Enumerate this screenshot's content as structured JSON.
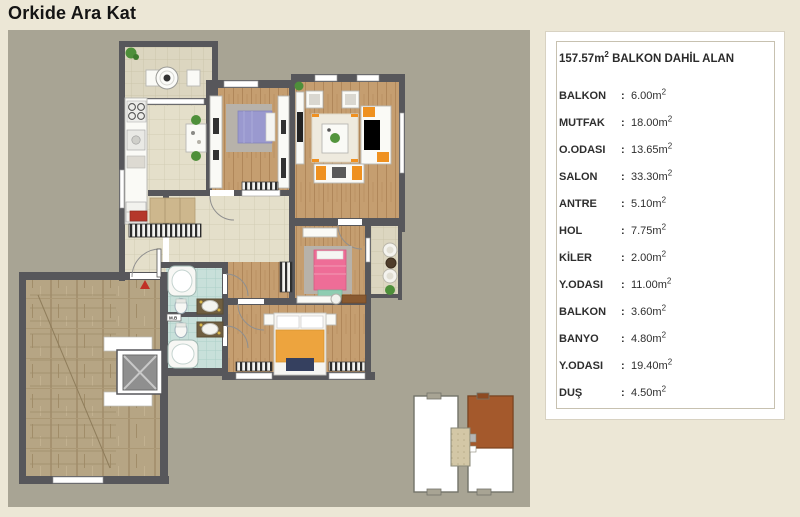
{
  "page": {
    "title": "Orkide Ara Kat"
  },
  "legend": {
    "header": {
      "area": "157.57",
      "unit": "m",
      "unit_sup": "2",
      "text": " BALKON DAHİL ALAN"
    },
    "colon": ":",
    "unit": "m",
    "unit_sup": "2",
    "rows": [
      {
        "label": "BALKON",
        "value": "6.00"
      },
      {
        "label": "MUTFAK",
        "value": "18.00"
      },
      {
        "label": "O.ODASI",
        "value": "13.65"
      },
      {
        "label": "SALON",
        "value": "33.30"
      },
      {
        "label": "ANTRE",
        "value": "5.10"
      },
      {
        "label": "HOL",
        "value": "7.75"
      },
      {
        "label": "KİLER",
        "value": "2.00"
      },
      {
        "label": "Y.ODASI",
        "value": "11.00"
      },
      {
        "label": "BALKON",
        "value": "3.60"
      },
      {
        "label": "BANYO",
        "value": "4.80"
      },
      {
        "label": "Y.ODASI",
        "value": "19.40"
      },
      {
        "label": "DUŞ",
        "value": "4.50"
      }
    ]
  },
  "plan": {
    "washer_label": "M.B"
  },
  "colors": {
    "page_bg": "#ece7d6",
    "plan_bg": "#a8a494",
    "wall": "#57575b",
    "wood_floor": "#c59e70",
    "tile_floor": "#e4dfca",
    "bath_floor": "#c8e0da",
    "keyplan_highlight": "#a4592c",
    "accent_orange": "#ef9120"
  }
}
